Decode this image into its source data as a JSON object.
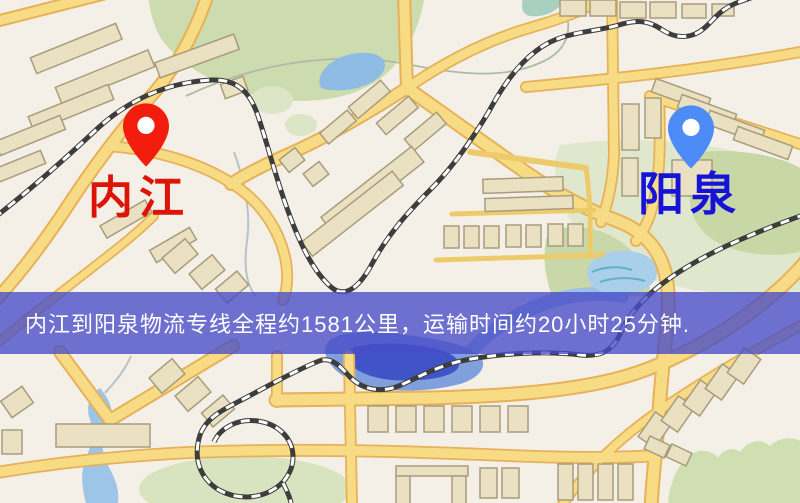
{
  "banner": {
    "text": "内江到阳泉物流专线全程约1581公里，运输时间约20小时25分钟.",
    "background_color": "#474bc7",
    "text_color": "#ffffff",
    "distance_km": "1581",
    "duration": "20小时25分钟"
  },
  "markers": {
    "origin": {
      "label": "内江",
      "label_color": "#dd1509",
      "pin_color": "#f21d0d",
      "pin_icon": "red-location-pin"
    },
    "destination": {
      "label": "阳泉",
      "label_color": "#1712d8",
      "pin_color": "#4d8cf6",
      "pin_icon": "blue-location-pin"
    }
  },
  "map": {
    "style": "street-map",
    "colors": {
      "background": "#f4f0e7",
      "road_fill": "#f8dc85",
      "road_casing": "#e6b158",
      "building": "#eae1c3",
      "green_area": "#ccdcae",
      "water": "#8fbce4",
      "deep_water": "#4054c8",
      "railway": "#3d3d3d"
    }
  }
}
